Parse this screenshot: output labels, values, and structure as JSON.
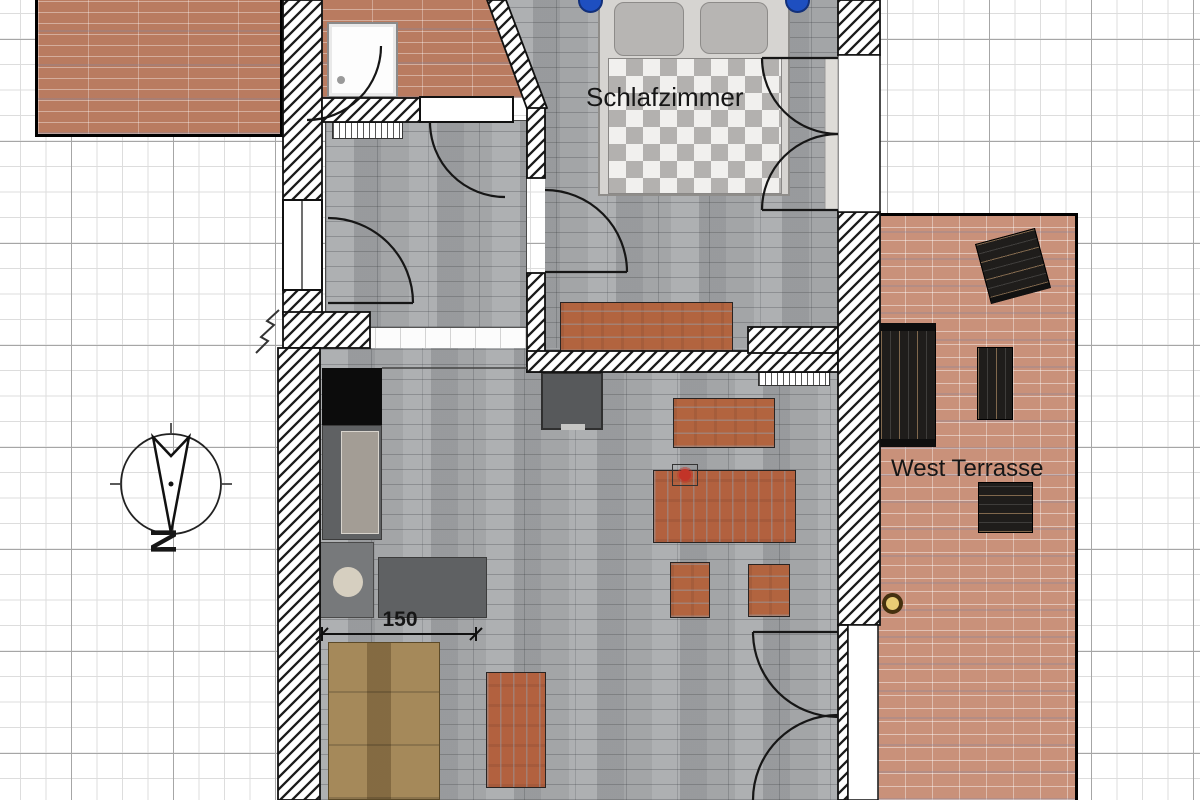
{
  "labels": {
    "bedroom": "Schlafzimmer",
    "terrace": "West Terrasse",
    "north": "N",
    "dimension": "150"
  },
  "colors": {
    "roof_tile": "#b97b60",
    "terrace_tile": "#c9917a",
    "floor_gray": "#a3a5a7",
    "furniture_wood_red": "#b2613f",
    "sofa_tan": "#a5895a",
    "nightstand_blue": "#1e4fc0",
    "door_knob_gold": "#e9cd74",
    "grid_major": "#a6a6a6",
    "grid_minor": "#dddddd",
    "wall_hatch": "#1a1a1a"
  }
}
